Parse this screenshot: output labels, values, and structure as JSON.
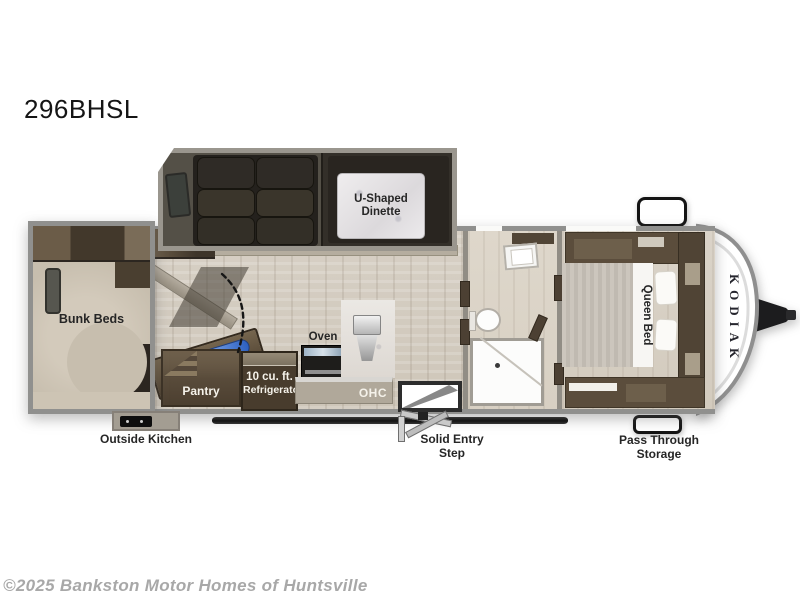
{
  "page": {
    "model": "296BHSL",
    "watermark": "©2025 Bankston Motor Homes of Huntsville"
  },
  "floorplan": {
    "brand": "KODIAK",
    "rooms": {
      "bunk_beds": "Bunk Beds",
      "dinette_line1": "U-Shaped",
      "dinette_line2": "Dinette",
      "queen_bed": "Queen Bed"
    },
    "kitchen": {
      "hinged_ent_ctr": "Hinged Ent Ctr",
      "pantry": "Pantry",
      "fridge_line1": "10 cu. ft.",
      "fridge_line2": "Refrigerator",
      "oven": "Oven",
      "ohc": "OHC"
    },
    "exterior": {
      "outside_kitchen": "Outside Kitchen",
      "solid_entry_line1": "Solid Entry",
      "solid_entry_line2": "Step",
      "pass_through_line1": "Pass Through",
      "pass_through_line2": "Storage"
    },
    "colors": {
      "wall_gray": "#90908e",
      "wood_floor": "#d7d0c5",
      "dark_furniture": "#2e2a25",
      "cabinet_brown": "#5b4d3c",
      "tv_accent_blue": "#3d6fd2",
      "label_dark": "#262626",
      "label_light": "#f5f2ea"
    }
  }
}
